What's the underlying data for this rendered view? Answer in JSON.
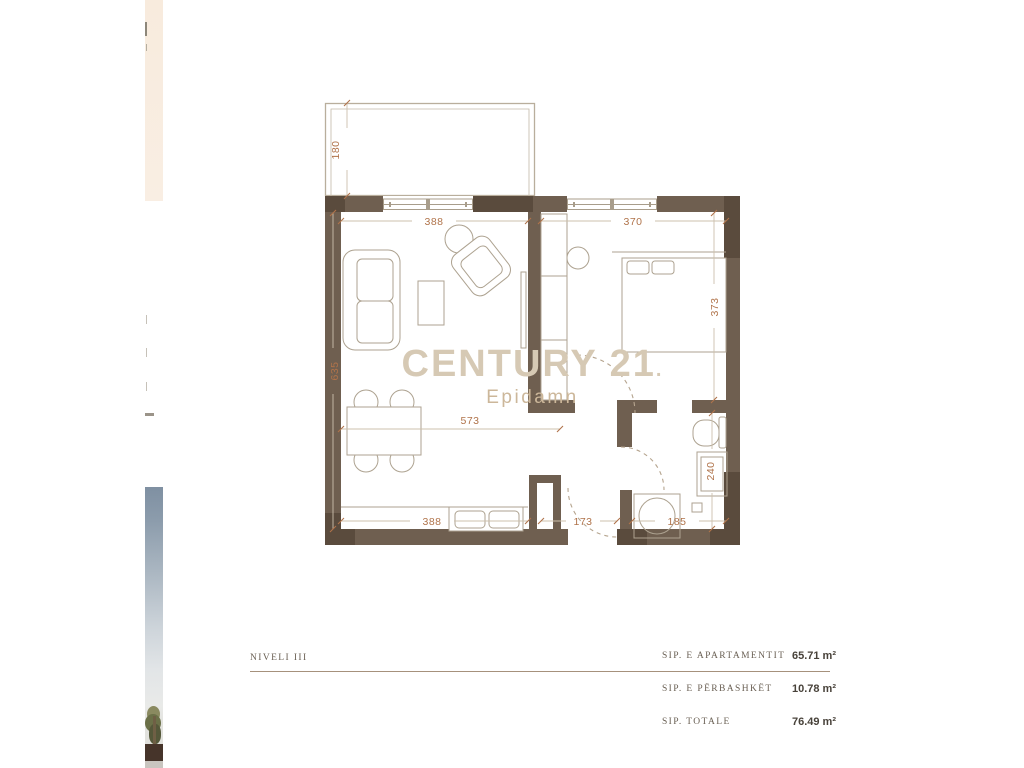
{
  "watermark": {
    "brand": "CENTURY 21",
    "brand_dot": ".",
    "office": "Epidamn"
  },
  "plan": {
    "dimensions": {
      "balcony_depth": "180",
      "living_room_width": "388",
      "bedroom_width": "370",
      "bedroom_depth": "373",
      "living_room_depth": "635",
      "living_kitchen_length": "573",
      "kitchen_width": "388",
      "hallway_width": "173",
      "bathroom_width": "185",
      "bathroom_depth": "240"
    },
    "colors": {
      "wall": "#6f5f50",
      "wall_dark": "#5a4b3d",
      "dimension_text": "#b0734a",
      "furniture_line": "#ada290",
      "watermark": "#d6c9b4"
    }
  },
  "areas_table": {
    "level_label": "NIVELI III",
    "rows": [
      {
        "label": "SIP. E APARTAMENTIT",
        "value": "65.71 m²"
      },
      {
        "label": "SIP. E PËRBASHKËT",
        "value": "10.78 m²"
      },
      {
        "label": "SIP. TOTALE",
        "value": "76.49 m²"
      }
    ]
  }
}
